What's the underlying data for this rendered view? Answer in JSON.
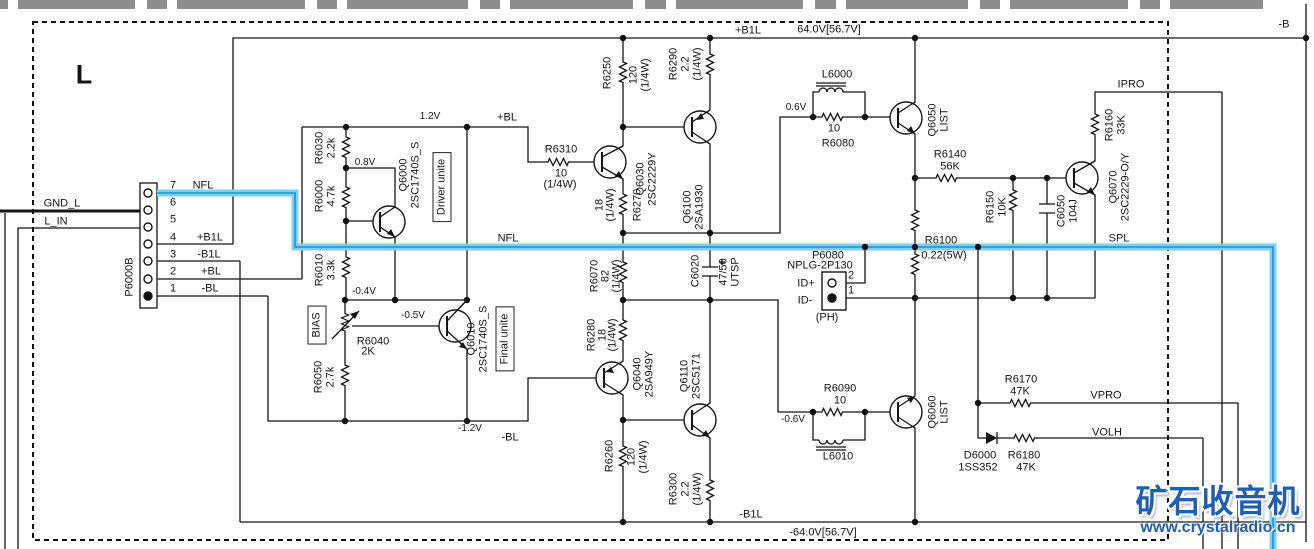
{
  "channel": "L",
  "watermark": {
    "title": "矿石收音机",
    "url": "www.crystalradio.cn"
  },
  "rails": {
    "pos_label": "+B1L",
    "pos_v": "64.0V[56.7V]",
    "neg_label": "-B1L",
    "neg_v": "-64.0V[56.7V]",
    "b_neg": "-B"
  },
  "nets": {
    "nfl": "NFL",
    "spl": "SPL",
    "ipro": "IPRO",
    "vpro": "VPRO",
    "volh": "VOLH",
    "bl_pos": "+BL",
    "bl_neg": "-BL",
    "gnd": "GND_L",
    "lin": "L_IN"
  },
  "voltages": {
    "v1_2": "1.2V",
    "v0_8": "0.8V",
    "vm0_4": "-0.4V",
    "vm0_5": "-0.5V",
    "vm1_2": "-1.2V",
    "v0_6": "0.6V",
    "vm0_6": "-0.6V"
  },
  "blocks": {
    "driver": "Driver unite",
    "final": "Final unite",
    "bias": "BIAS"
  },
  "connector": {
    "name": "P6000B",
    "pins": [
      {
        "n": "7",
        "label": "NFL"
      },
      {
        "n": "6",
        "label": ""
      },
      {
        "n": "5",
        "label": ""
      },
      {
        "n": "4",
        "label": "+B1L"
      },
      {
        "n": "3",
        "label": "-B1L"
      },
      {
        "n": "2",
        "label": "+BL"
      },
      {
        "n": "1",
        "label": "-BL"
      }
    ]
  },
  "p6080": {
    "ref": "P6080",
    "part": "NPLG-2P130",
    "pin2": "2",
    "pin1": "1",
    "id_pos": "ID+",
    "id_neg": "ID-",
    "ph": "(PH)"
  },
  "components": {
    "r6030": {
      "ref": "R6030",
      "val": "2.2k"
    },
    "r6000": {
      "ref": "R6000",
      "val": "4.7k"
    },
    "r6010": {
      "ref": "R6010",
      "val": "3.3k"
    },
    "r6040": {
      "ref": "R6040",
      "val": "2K"
    },
    "r6050": {
      "ref": "R6050",
      "val": "2.7k"
    },
    "r6310": {
      "ref": "R6310",
      "val": "10",
      "watt": "(1/4W)"
    },
    "r6250": {
      "ref": "R6250",
      "val": "120",
      "watt": "(1/4W)"
    },
    "r6270": {
      "ref": "R6270",
      "val": "18",
      "watt": "(1/4W)"
    },
    "r6290": {
      "ref": "R6290",
      "val": "2.2",
      "watt": "(1/4W)"
    },
    "r6070": {
      "ref": "R6070",
      "val": "82",
      "watt": "(1/4W)"
    },
    "r6280": {
      "ref": "R6280",
      "val": "18",
      "watt": "(1/4W)"
    },
    "r6260": {
      "ref": "R6260",
      "val": "120",
      "watt": "(1/4W)"
    },
    "r6300": {
      "ref": "R6300",
      "val": "2.2",
      "watt": "(1/4W)"
    },
    "r6080": {
      "ref": "R6080",
      "val": "10"
    },
    "r6090": {
      "ref": "R6090",
      "val": "10"
    },
    "r6100": {
      "ref": "R6100",
      "val": "0.22(5W)"
    },
    "r6140": {
      "ref": "R6140",
      "val": "56K"
    },
    "r6150": {
      "ref": "R6150",
      "val": "10K"
    },
    "r6160": {
      "ref": "R6160",
      "val": "33K"
    },
    "r6170": {
      "ref": "R6170",
      "val": "47K"
    },
    "r6180": {
      "ref": "R6180",
      "val": "47K"
    },
    "l6000": {
      "ref": "L6000"
    },
    "l6010": {
      "ref": "L6010"
    },
    "c6020": {
      "ref": "C6020",
      "val": "47/50",
      "type": "UTSP"
    },
    "c6050": {
      "ref": "C6050",
      "val": "104J"
    },
    "d6000": {
      "ref": "D6000",
      "part": "1SS352"
    },
    "q6000": {
      "ref": "Q6000",
      "part": "2SC1740S_S"
    },
    "q6010": {
      "ref": "Q6010",
      "part": "2SC1740S_S"
    },
    "q6030": {
      "ref": "Q6030",
      "part": "2SC2229Y"
    },
    "q6100": {
      "ref": "Q6100",
      "part": "2SA1930"
    },
    "q6040": {
      "ref": "Q6040",
      "part": "2SA949Y"
    },
    "q6110": {
      "ref": "Q6110",
      "part": "2SC5171"
    },
    "q6050": {
      "ref": "Q6050",
      "part": "LIST"
    },
    "q6060": {
      "ref": "Q6060",
      "part": "LIST"
    },
    "q6070": {
      "ref": "Q6070",
      "part": "2SC2229-O/Y"
    }
  }
}
